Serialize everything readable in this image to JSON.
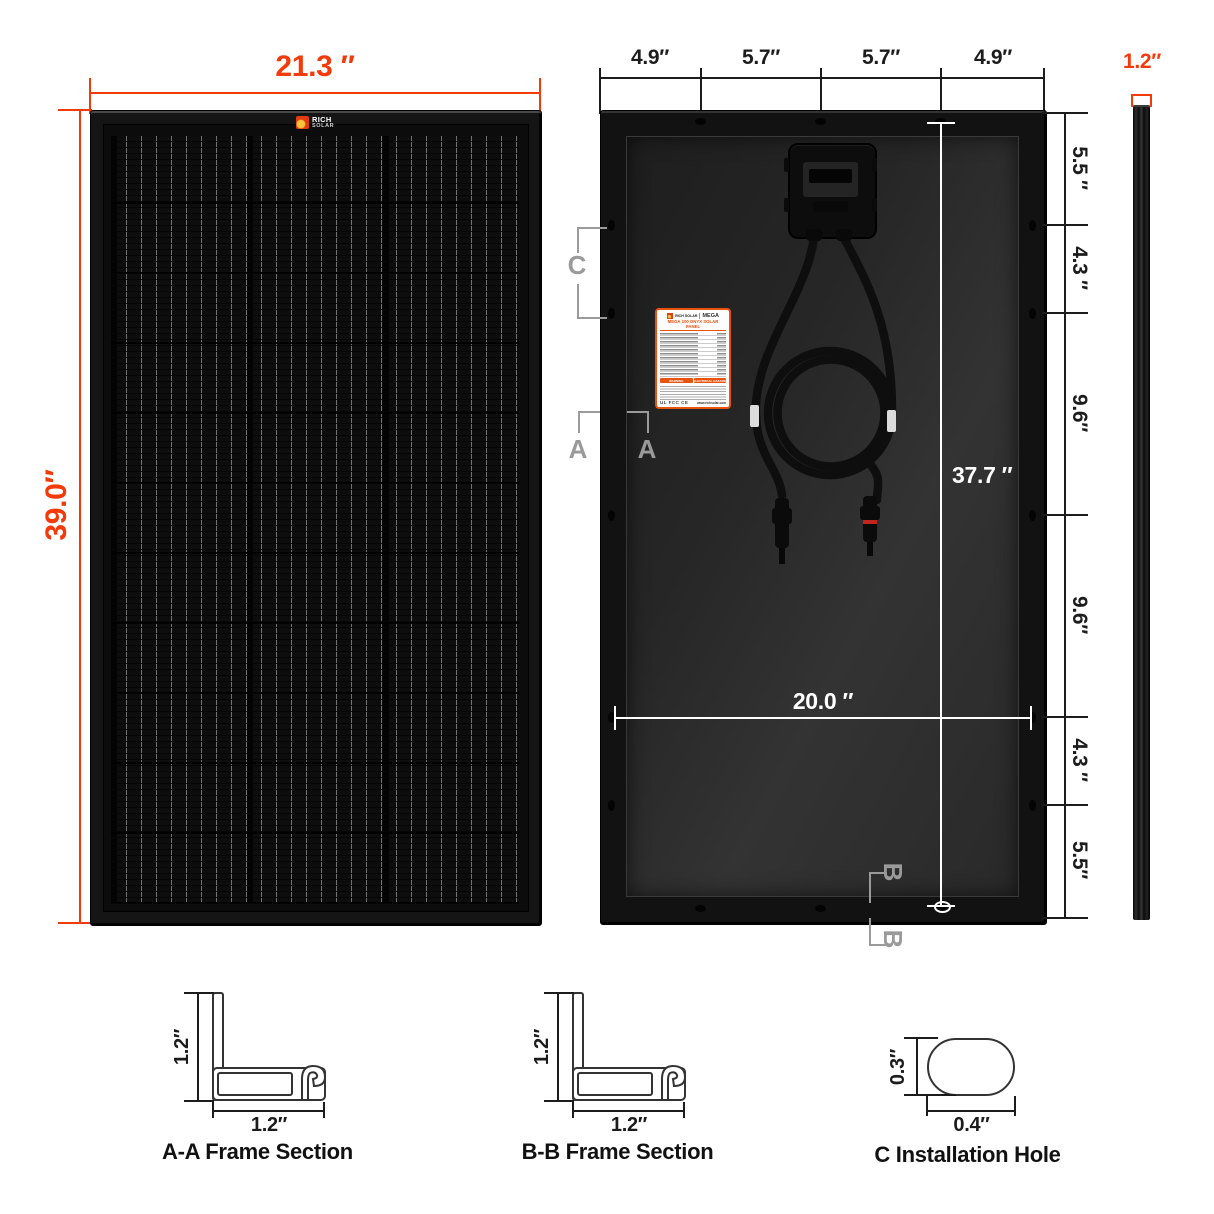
{
  "front_view": {
    "width_dim": "21.3 ″",
    "height_dim": "39.0″",
    "logo_line1": "RICH",
    "logo_line2": "SOLAR"
  },
  "back_view": {
    "top_dims": [
      "4.9″",
      "5.7″",
      "5.7″",
      "4.9″"
    ],
    "right_dims": [
      "5.5 ″",
      "4.3 ″",
      "9.6″",
      "9.6″",
      "4.3 ″",
      "5.5″"
    ],
    "inner_height_dim": "37.7 ″",
    "inner_width_dim": "20.0 ″",
    "marker_c": "C",
    "marker_a": "A",
    "marker_b": "B",
    "spec_label": {
      "brand": "RICH SOLAR",
      "series": "MEGA",
      "title": "MEGA 100 ONYX SOLAR PANEL",
      "warning_left": "WARNING",
      "warning_right": "ELECTRICAL HAZARD",
      "certs": "UL FCC CE",
      "website": "www.richsolar.com"
    }
  },
  "side_view": {
    "width_dim": "1.2″"
  },
  "sections": {
    "aa": {
      "caption": "A-A Frame Section",
      "v_dim": "1.2″",
      "h_dim": "1.2″"
    },
    "bb": {
      "caption": "B-B Frame Section",
      "v_dim": "1.2″",
      "h_dim": "1.2″"
    },
    "c": {
      "caption": "C Installation Hole",
      "v_dim": "0.3″",
      "h_dim": "0.4″"
    }
  },
  "colors": {
    "accent": "#F23A0B",
    "dim_black": "#1c1c1c",
    "marker_gray": "#9a9a9a"
  }
}
